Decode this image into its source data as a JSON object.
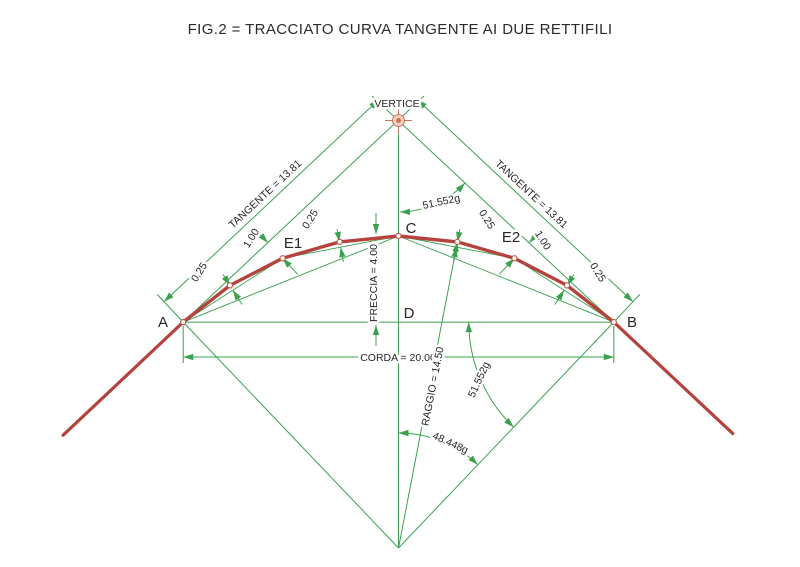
{
  "title": "FIG.2  = TRACCIATO CURVA TANGENTE AI  DUE RETTIFILI",
  "colors": {
    "construction_green": "#3aa14f",
    "alignment_red": "#b4433e",
    "vertex_symbol_orange": "#c9745a",
    "text": "#262626"
  },
  "labels": {
    "vertex": "VERTICE",
    "point_a": "A",
    "point_b": "B",
    "point_c": "C",
    "point_d": "D",
    "point_e1": "E1",
    "point_e2": "E2",
    "tangent_left": "TANGENTE = 13.81",
    "tangent_right": "TANGENTE = 13.81",
    "corda": "CORDA = 20.00",
    "freccia": "FRECCIA = 4.00",
    "raggio": "RAGGIO = 14.50",
    "angle_vertex": "51.552g",
    "angle_chord_radius": "51.552g",
    "angle_center": "48.448g",
    "offset_left_near_a": "0.25",
    "offset_left_mid": "1.00",
    "offset_left_near_c": "0.25",
    "offset_right_near_c": "0.25",
    "offset_right_mid": "1.00",
    "offset_right_near_b": "0.25"
  }
}
